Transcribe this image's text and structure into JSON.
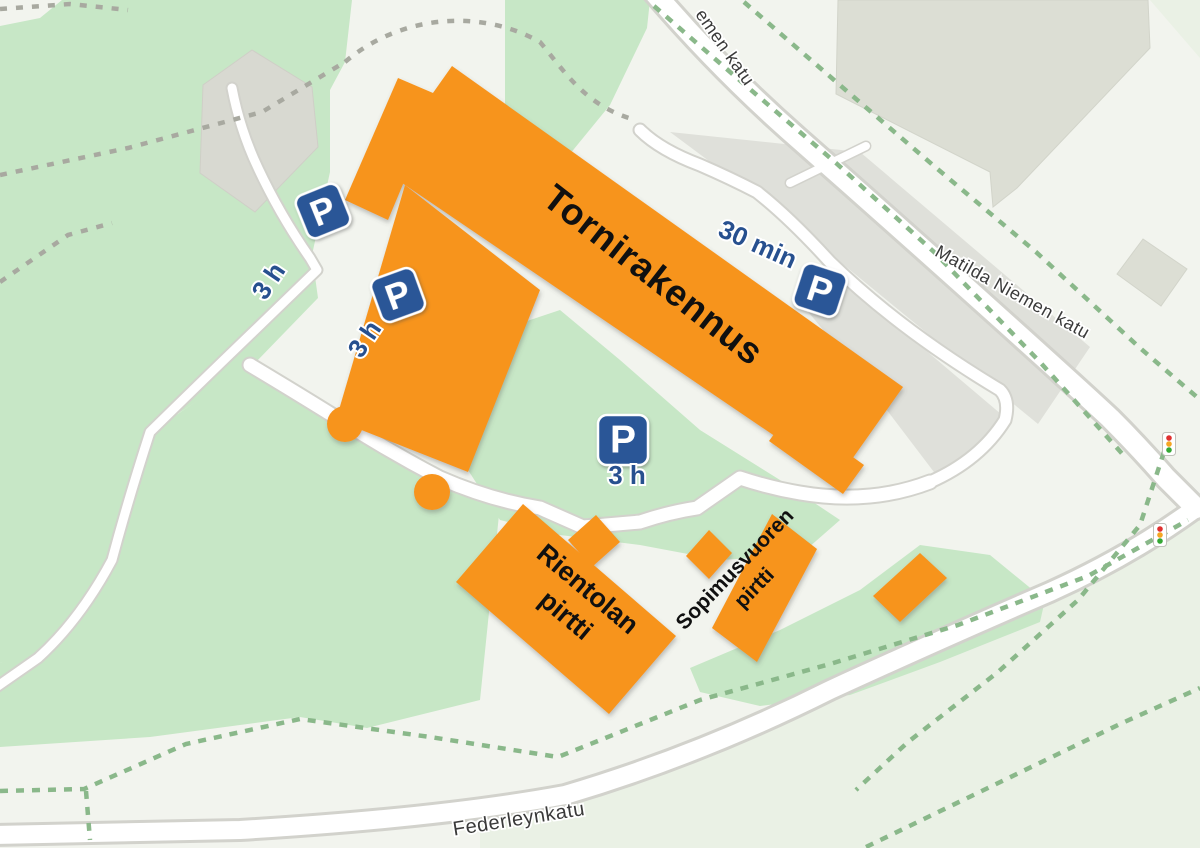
{
  "map": {
    "type": "parking-guidance-map",
    "streets": [
      {
        "id": "street-top-partial",
        "name": "emen katu"
      },
      {
        "id": "street-matilda",
        "name": "Matilda Niemen katu"
      },
      {
        "id": "street-federleynkatu",
        "name": "Federleynkatu"
      }
    ],
    "buildings": [
      {
        "id": "tornirakennus",
        "label": "Tornirakennus"
      },
      {
        "id": "rientolan-pirtti",
        "label_line1": "Rientolan",
        "label_line2": "pirtti"
      },
      {
        "id": "sopimusvuoren-pirtti",
        "label_line1": "Sopimusvuoren",
        "label_line2": "pirtti"
      }
    ],
    "parking": {
      "sign_letter": "P",
      "spots": [
        {
          "id": "west-upper",
          "duration": "3 h"
        },
        {
          "id": "west-lower",
          "duration": "3 h"
        },
        {
          "id": "north",
          "duration": "30 min"
        },
        {
          "id": "courtyard",
          "duration": "3 h"
        }
      ]
    },
    "icons": [
      "parking-icon",
      "traffic-light-icon"
    ],
    "colors": {
      "background": "#f2f4ee",
      "pale_green": "#eaf1e5",
      "park_green": "#c7e7c6",
      "building_orange": "#f7941d",
      "gray_building": "#dcded4",
      "gray_building_dark": "#d8d9d1",
      "gray_lot": "#dfe0da",
      "road_white": "#ffffff",
      "road_casing": "#d2d2cc",
      "path_dash_green": "#8ab88a",
      "path_dash_gray": "#a8a9a0",
      "parking_sign_blue": "#2b5797",
      "parking_text_blue": "#27508f",
      "street_label_gray": "#3a3a3a",
      "building_label_black": "#101010",
      "traffic_red": "#e03030",
      "traffic_amber": "#f5a623",
      "traffic_green": "#35a835"
    }
  }
}
